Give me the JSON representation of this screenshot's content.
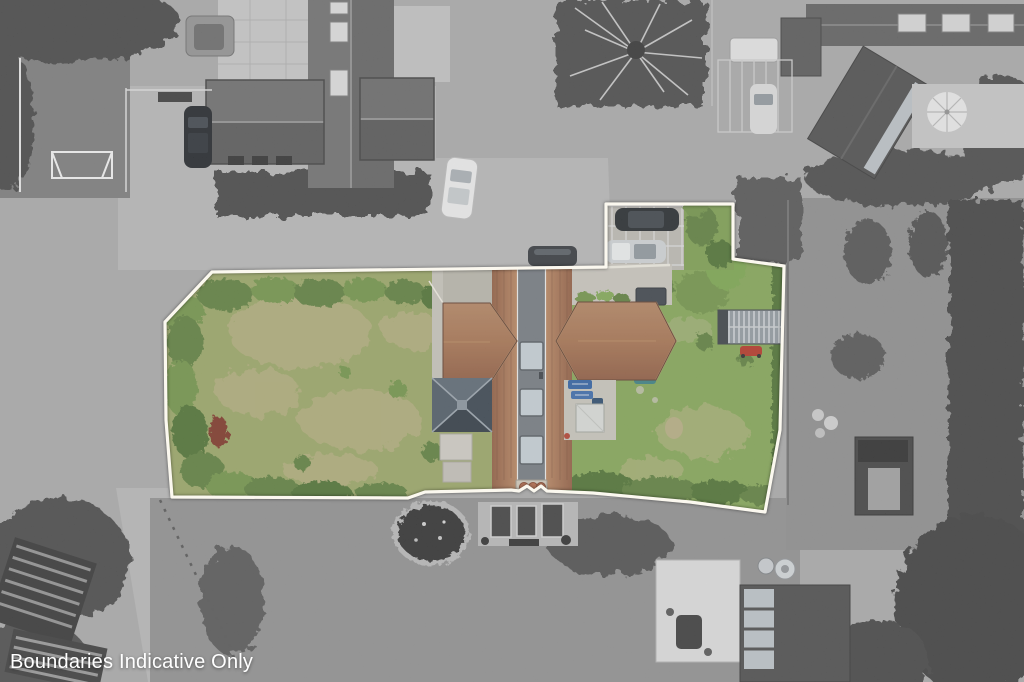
{
  "caption": "Boundaries Indicative Only",
  "scene": {
    "type": "aerial-drone-photograph",
    "description": "Top-down estate-agent aerial photo; the plot inside the white indicative boundary is shown in colour (gardens, terracotta-roofed house, carport with two cars, metal shed) while all surrounding properties are desaturated to grayscale."
  },
  "boundary": {
    "points": "212,272 606,267 606,204 733,204 733,259 784,266 780,430 765,512 690,502 593,493 547,491 541,486 534,491 527,486 519,491 511,490 425,492 408,498 172,497 166,420 165,322",
    "stroke_color": "#fbf8ef"
  },
  "colors": {
    "surroundBase": "#a7a7a7",
    "driveway": "#b4b4b4",
    "lawnGray": "#8e8e8e",
    "treeGray": "#454545",
    "paving": "#c4c4c4",
    "carDark": "#24282c",
    "carSilver": "#ccd0d2",
    "grassLeft": "#98a464",
    "grassRight": "#82a455",
    "dryGrass": "#b5ab7e",
    "bushDark": "#4e7033",
    "bushMid": "#5d7d3d",
    "bushLight": "#6f9147",
    "roofTerracotta": "#a4714f",
    "roofTerracottaDark": "#8a583f",
    "grayStrip": "#72787e",
    "skylight": "#c3ccd2",
    "slate": "#46525d",
    "shedMetal": "#8f979d",
    "mowerRed": "#b23425",
    "boundaryWhite": "#fbf8ef",
    "captionWhite": "#ffffff"
  }
}
